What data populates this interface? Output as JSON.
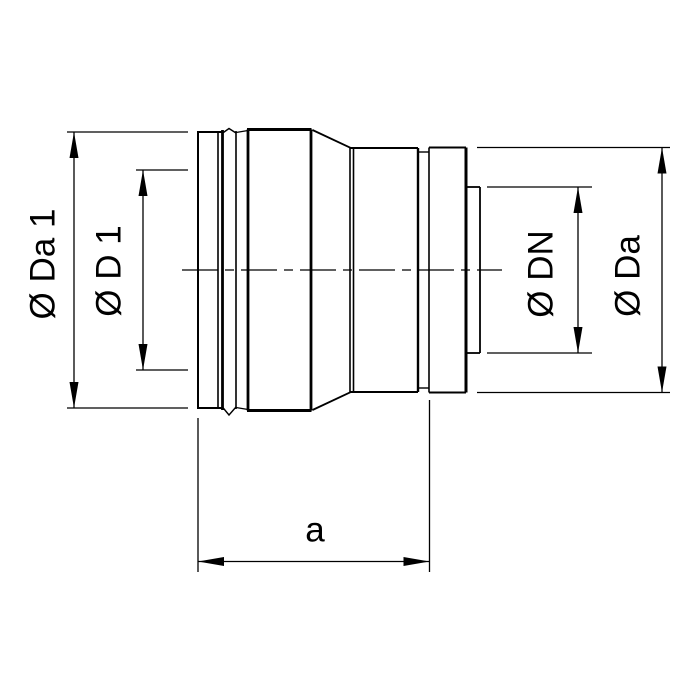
{
  "drawing": {
    "type": "technical-drawing",
    "subject": "concentric-pipe-reducer-side-view",
    "background_color": "#ffffff",
    "line_color": "#000000",
    "labels": {
      "diameter_da1": "Ø Da 1",
      "diameter_d1": "Ø D 1",
      "diameter_dn": "Ø DN",
      "diameter_da": "Ø Da",
      "length_a": "a"
    }
  }
}
